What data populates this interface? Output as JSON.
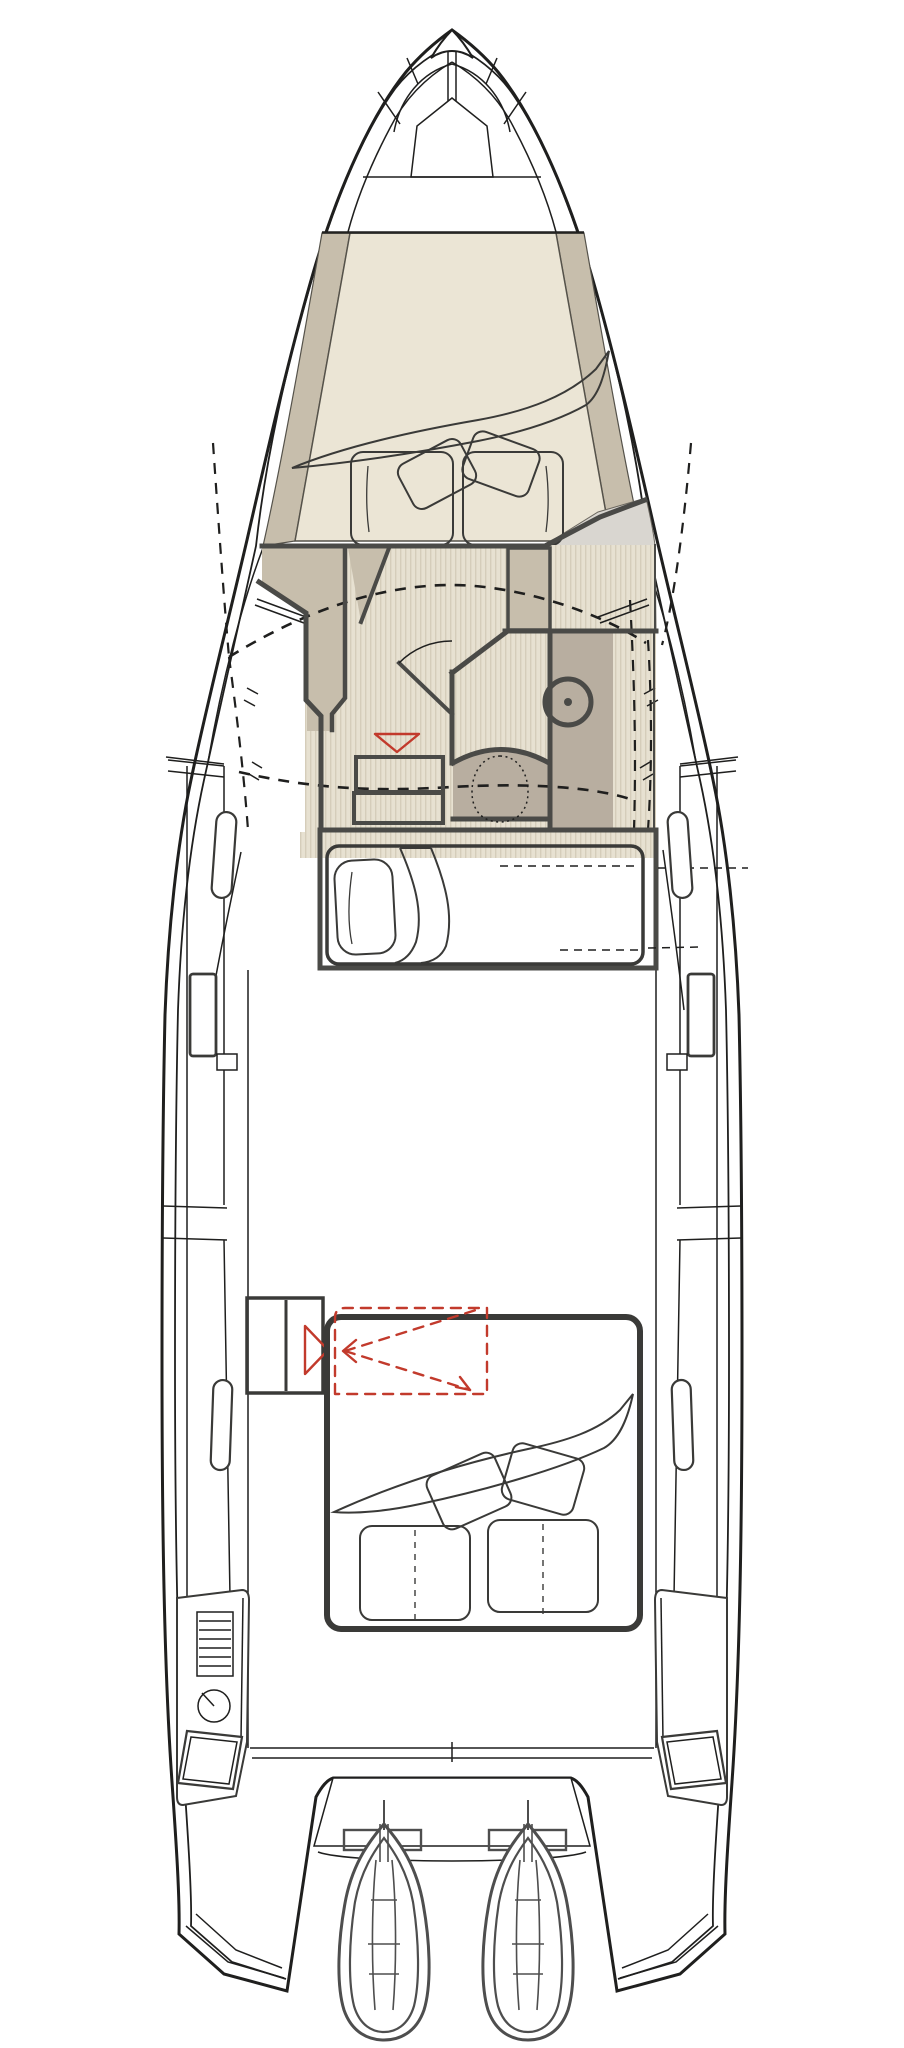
{
  "document": {
    "kind": "boat-deck-floor-plan",
    "visible_text": []
  },
  "palette": {
    "background": "#ffffff",
    "hull_line": "#1f1f1e",
    "wall": "#4a4a47",
    "furniture_line": "#3a3a38",
    "cream": "#ebe5d5",
    "tan": "#c7beac",
    "tan_dark": "#b8aea0",
    "gray_light": "#d9d6d0",
    "stripe_bg": "#e7e1d1",
    "stripe_line": "#d5cdba",
    "step_bg": "#cfc7b5",
    "step_line": "#bfb6a2",
    "accent_red": "#c23a2c",
    "engine_line": "#4e4e4e"
  },
  "components": [
    "hull-outline",
    "rub-rail",
    "deck-edge-lines",
    "bow-tip",
    "anchor-locker",
    "foredeck-hatch",
    "foredeck-band",
    "forward-cabin",
    "forward-berth",
    "blanket",
    "pillows",
    "berth-cushions",
    "companionway-floor",
    "head-compartment",
    "sink",
    "toilet",
    "shower-door",
    "storage-steps",
    "red-sink-marker",
    "deck-opening-dashed-outline",
    "mid-berth",
    "side-deck-cleats",
    "gunwale-panels",
    "cockpit",
    "aft-steps",
    "aft-berth",
    "folding-table-dashed",
    "transom",
    "swim-platform",
    "engine-brackets",
    "outboard-engine-port",
    "outboard-engine-starboard",
    "stern-console-grill",
    "stern-console-gauge",
    "stern-steps"
  ]
}
